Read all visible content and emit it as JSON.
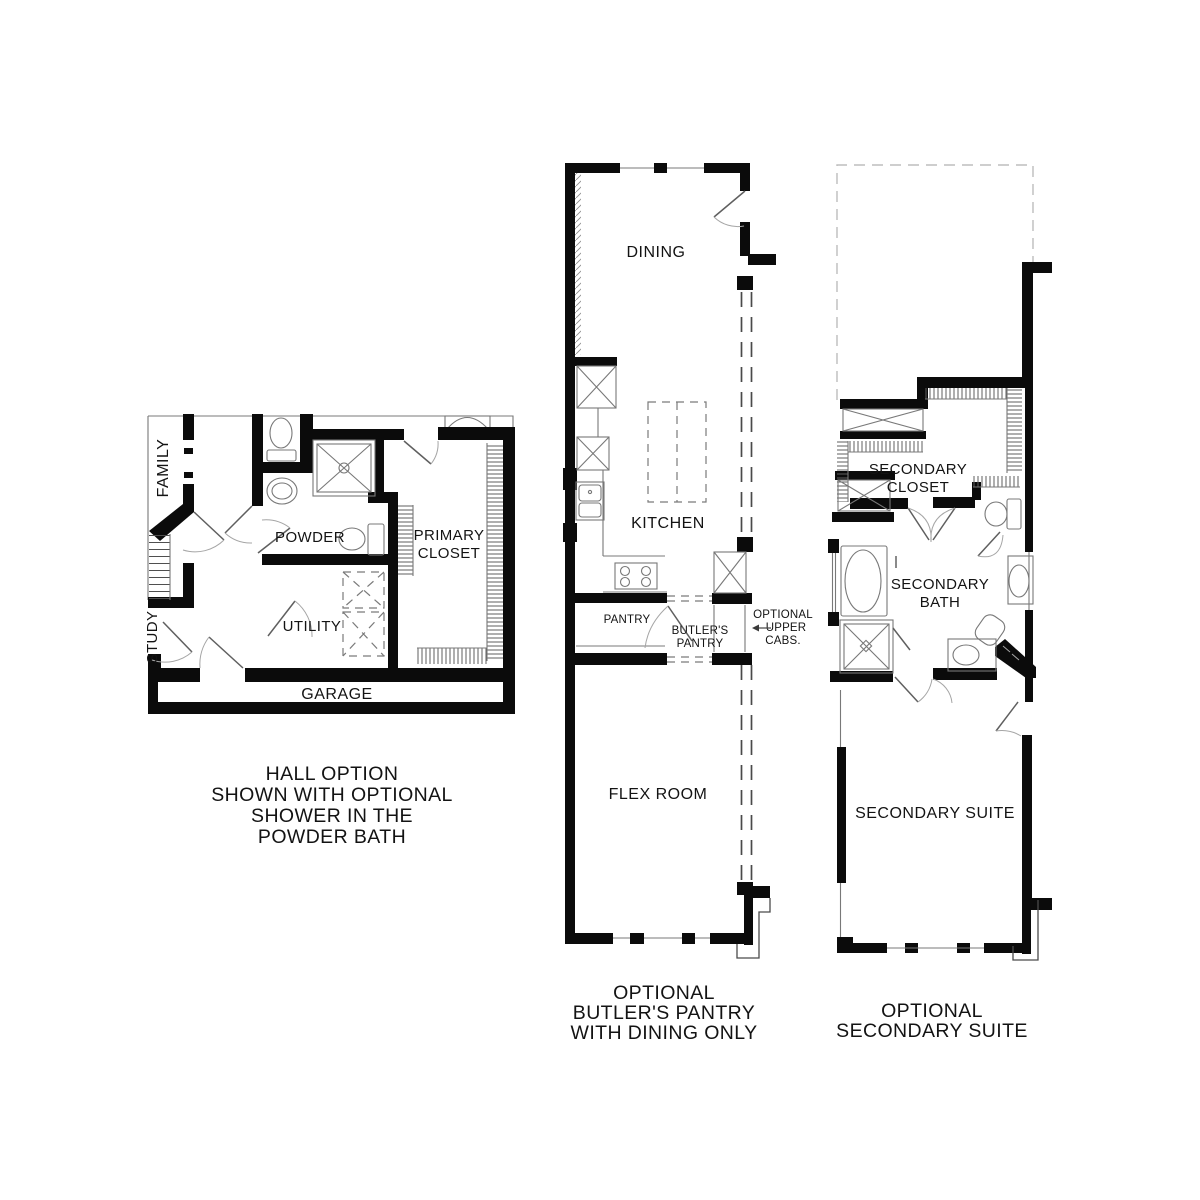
{
  "document_type": "floor-plan-options-sheet",
  "colors": {
    "background": "#ffffff",
    "wall": "#0b0b0b",
    "fixture_line": "#787878",
    "optional_dash": "#4a4a4a",
    "light_dash": "#bdbdbd",
    "text": "#131313"
  },
  "plans": {
    "hall_option": {
      "rooms": {
        "family": "FAMILY",
        "powder": "POWDER",
        "primary_line1": "PRIMARY",
        "primary_line2": "CLOSET",
        "study": "STUDY",
        "utility": "UTILITY",
        "garage": "GARAGE"
      },
      "caption_lines": [
        "HALL OPTION",
        "SHOWN WITH OPTIONAL",
        "SHOWER IN THE",
        "POWDER BATH"
      ]
    },
    "butlers_pantry": {
      "rooms": {
        "dining": "DINING",
        "kitchen": "KITCHEN",
        "pantry": "PANTRY",
        "butlers_line1": "BUTLER'S",
        "butlers_line2": "PANTRY",
        "flex_room": "FLEX ROOM"
      },
      "annotation_lines": [
        "OPTIONAL",
        "UPPER",
        "CABS."
      ],
      "caption_lines": [
        "OPTIONAL",
        "BUTLER'S PANTRY",
        "WITH DINING ONLY"
      ]
    },
    "secondary_suite": {
      "rooms": {
        "closet_line1": "SECONDARY",
        "closet_line2": "CLOSET",
        "bath_line1": "SECONDARY",
        "bath_line2": "BATH",
        "suite": "SECONDARY SUITE"
      },
      "caption_lines": [
        "OPTIONAL",
        "SECONDARY SUITE"
      ]
    }
  }
}
